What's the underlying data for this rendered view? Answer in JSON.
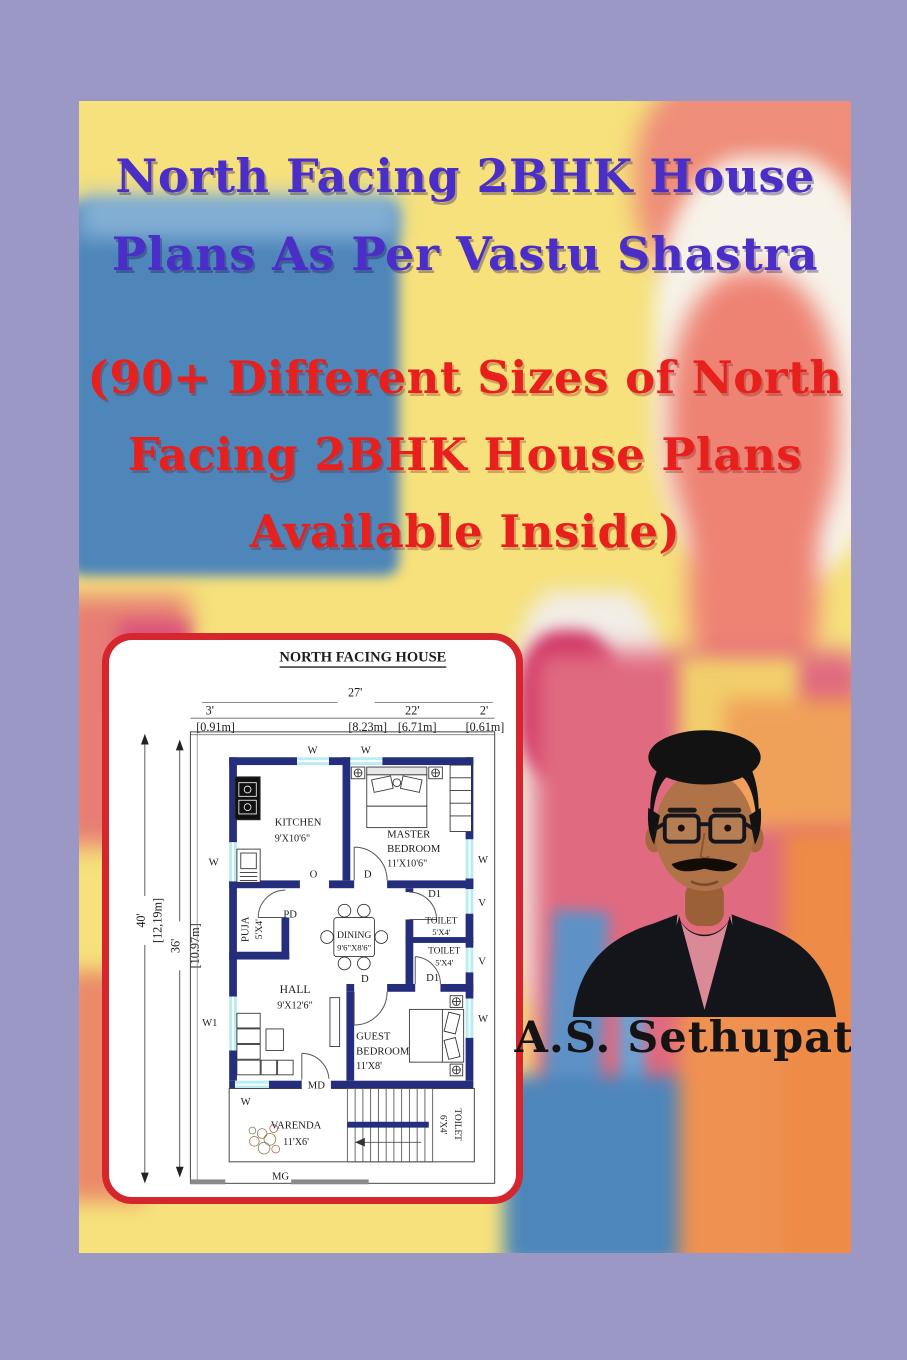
{
  "page": {
    "border_color": "#9c98c6"
  },
  "cover": {
    "title": [
      "North Facing 2BHK House",
      "Plans As Per Vastu Shastra"
    ],
    "subtitle": [
      "(90+ Different Sizes of North",
      "Facing 2BHK House Plans",
      "Available Inside)"
    ],
    "title_color": "#4b2dc7",
    "subtitle_color": "#e8201d",
    "author": "A.S. Sethupathi"
  },
  "floor_plan": {
    "heading": "NORTH FACING HOUSE",
    "dims": {
      "total_ft": "27'",
      "total_m": "[8.23m]",
      "left_ft": "3'",
      "left_m": "[0.91m]",
      "mid_ft": "22'",
      "mid_m": "[6.71m]",
      "right_ft": "2'",
      "right_m": "[0.61m]",
      "depth_outer_ft": "40'",
      "depth_outer_m": "[12,19m]",
      "depth_inner_ft": "36'",
      "depth_inner_m": "[10.97m]"
    },
    "rooms": {
      "kitchen": {
        "name": "KITCHEN",
        "size": "9'X10'6\""
      },
      "master": {
        "l1": "MASTER",
        "l2": "BEDROOM",
        "size": "11'X10'6\""
      },
      "puja": {
        "name": "PUJA",
        "size": "5'X4'"
      },
      "dining": {
        "name": "DINING",
        "size": "9'6\"X8'6\""
      },
      "toilet1": {
        "name": "TOILET",
        "size": "5'X4'"
      },
      "toilet2": {
        "name": "TOILET",
        "size": "5'X4'"
      },
      "hall": {
        "name": "HALL",
        "size": "9'X12'6\""
      },
      "guest": {
        "l1": "GUEST",
        "l2": "BEDROOM",
        "size": "11'X8'"
      },
      "varenda": {
        "name": "VARENDA",
        "size": "11'X6'"
      },
      "stair_toilet": {
        "name": "TOILET",
        "size": "6'X4'"
      }
    },
    "markers": {
      "w": "W",
      "w1": "W1",
      "v": "V",
      "d": "D",
      "d1": "D1",
      "pd": "PD",
      "md": "MD",
      "o": "O",
      "mg": "MG"
    },
    "colors": {
      "wall": "#252e7d",
      "window": "#b9ecf4",
      "card_border": "#d4262c"
    }
  }
}
